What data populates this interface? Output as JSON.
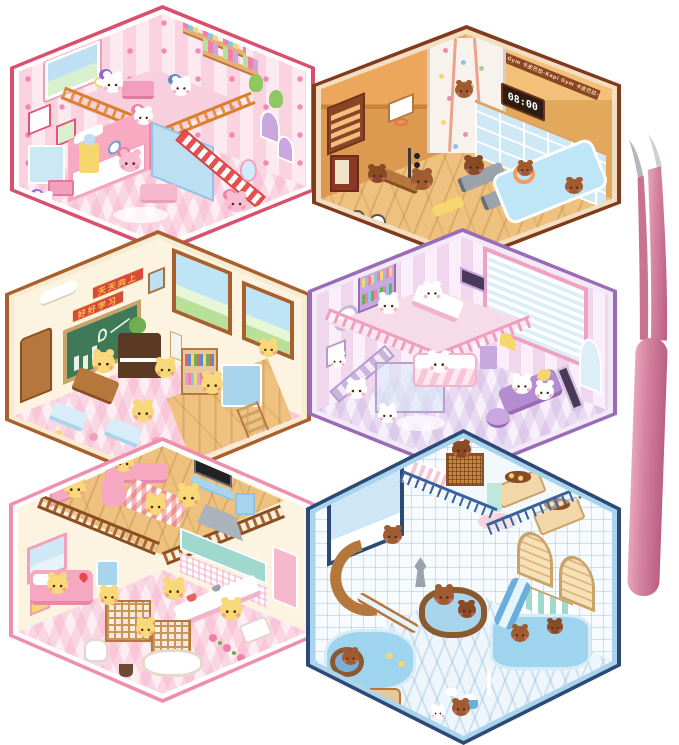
{
  "product": {
    "title": "hexagonal 3D sticker room scenes with tweezers",
    "scene_count": 6
  },
  "texts": {
    "gym_banner": "卡皮巴拉-Kapi Gym 卡皮巴拉-Kapi Gym 卡皮巴拉-Kapi Gym",
    "gym_clock": "08:00",
    "classroom_sign_line1": "天天向上",
    "classroom_sign_line2": "好好学习"
  },
  "scenes": [
    {
      "id": "pony-bedroom",
      "label": "pink pony loft bedroom",
      "frame_color": "#d9506e",
      "inner_line": "#ffffff",
      "characters": "ponies"
    },
    {
      "id": "capybara-gym",
      "label": "capybara climbing gym",
      "frame_color": "#803a1c",
      "inner_line": "#f2dfc2",
      "characters": "capybaras"
    },
    {
      "id": "bear-classroom",
      "label": "bear classroom with chalkboard",
      "frame_color": "#a8602e",
      "inner_line": "#f7ecd2",
      "characters": "bears"
    },
    {
      "id": "puppy-bedroom",
      "label": "lavender puppy loft bedroom",
      "frame_color": "#9a6cb8",
      "inner_line": "#f3eaf8",
      "characters": "puppies"
    },
    {
      "id": "bear-home",
      "label": "bear duplex home with kitchen",
      "frame_color": "#ef8fae",
      "inner_line": "#ffffff",
      "characters": "bears"
    },
    {
      "id": "capybara-bathhouse",
      "label": "capybara bath house with slide",
      "frame_color": "#2c4a78",
      "inner_line": "#aad4ec",
      "characters": "capybaras"
    }
  ],
  "tool": {
    "label": "pink curved tweezers",
    "color": "#d5829f",
    "tip_color": "#c4c8cc"
  }
}
